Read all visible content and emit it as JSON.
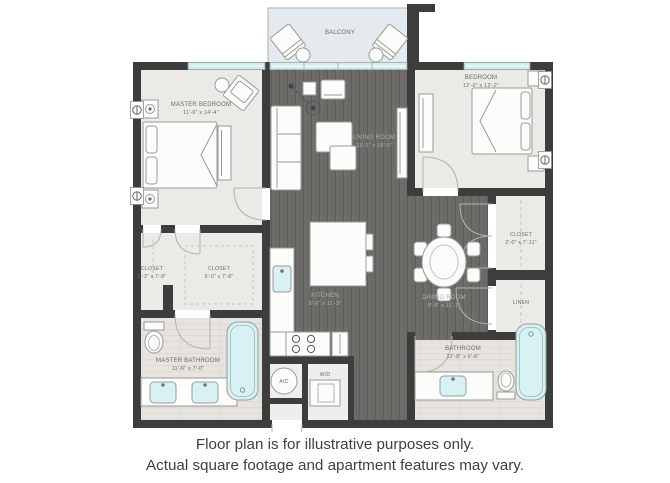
{
  "caption": {
    "line1": "Floor plan is for illustrative purposes only.",
    "line2": "Actual square footage and apartment features may vary."
  },
  "rooms": {
    "balcony": {
      "name": "BALCONY"
    },
    "master_bedroom": {
      "name": "MASTER BEDROOM",
      "dims": "11'-6\" x 14'-4\""
    },
    "bedroom": {
      "name": "BEDROOM",
      "dims": "12'-0\" x 12'-2\""
    },
    "living_room": {
      "name": "LIVING ROOM",
      "dims": "13'-1\" x 18'-9\""
    },
    "kitchen": {
      "name": "KITCHEN",
      "dims": "8'-6\" x 11'-3\""
    },
    "dining_room": {
      "name": "DINING ROOM",
      "dims": "9'-9\" x 11'-1\""
    },
    "closet_a": {
      "name": "CLOSET",
      "dims": "2'-3\" x 7'-8\""
    },
    "closet_b": {
      "name": "CLOSET",
      "dims": "5'-0\" x 7'-8\""
    },
    "closet_c": {
      "name": "CLOSET",
      "dims": "2'-0\" x 7'-11\""
    },
    "linen": {
      "name": "LINEN"
    },
    "master_bathroom": {
      "name": "MASTER BATHROOM",
      "dims": "11'-6\" x 7'-0\""
    },
    "bathroom": {
      "name": "BATHROOM",
      "dims": "12'-8\" x 6'-6\""
    }
  },
  "utilities": {
    "ac": "A/C",
    "wd": "W/D"
  },
  "colors": {
    "wall": "#3d3d3d",
    "dark_floor": "#6b6a67",
    "light_room": "#ebeae6",
    "bath_floor": "#e7e4e0",
    "balcony_floor": "#e4eaee",
    "window_glass": "#cdeef0",
    "water_fixture": "#d8f1f3",
    "caption_text": "#3f3f3f"
  }
}
